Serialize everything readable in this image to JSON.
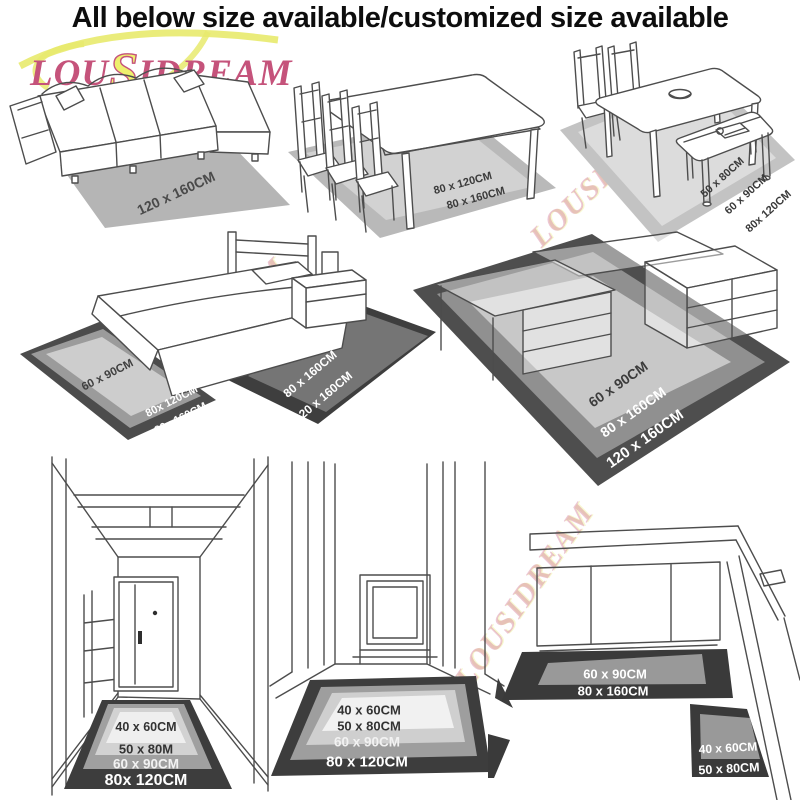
{
  "title": "All below size available/customized size available",
  "brand": {
    "logo_text": "LOUSIDREAM",
    "logo_parts": {
      "lou": "LOU",
      "s": "S",
      "idream": "IDREAM"
    }
  },
  "colors": {
    "logo_pink": "#c5537b",
    "logo_yellow": "#e8ea6d",
    "rug_dark": "#3d3d3d",
    "rug_mid": "#9a9a9a",
    "rug_light": "#cfcfcf",
    "rug_lightest": "#efefef",
    "title_text": "#0d0d0d"
  },
  "scenes": {
    "sofa": {
      "rug_label": "120 x 160CM"
    },
    "dining_table": {
      "labels": {
        "l1": "80 x 120CM",
        "l2": "80 x 160CM"
      }
    },
    "dining_bench": {
      "labels": {
        "l1": "50 x 80CM",
        "l2": "60 x 90CM",
        "l3": "80x 120CM"
      }
    },
    "bedroom": {
      "left_rug": {
        "l1": "60 x 90CM",
        "l2": "80x 120CM",
        "l3": "80x 160CM"
      },
      "right_rug": {
        "l1": "80 x 160CM",
        "l2": "120 x 160CM"
      }
    },
    "desk": {
      "labels": {
        "l1": "60 x 90CM",
        "l2": "80 x 160CM",
        "l3": "120 x 160CM"
      }
    },
    "hallway_door": {
      "labels": {
        "l1": "40 x 60CM",
        "l2": "50 x 80M",
        "l3": "60 x 90CM",
        "l4": "80x 120CM"
      }
    },
    "hallway": {
      "labels": {
        "l1": "40 x 60CM",
        "l2": "50 x 80CM",
        "l3": "60 x 90CM",
        "l4": "80 x 120CM"
      }
    },
    "kitchen": {
      "runner": {
        "l1": "60 x 90CM",
        "l2": "80 x 160CM"
      },
      "mat": {
        "l1": "40 x 60CM",
        "l2": "50 x 80CM"
      }
    }
  }
}
